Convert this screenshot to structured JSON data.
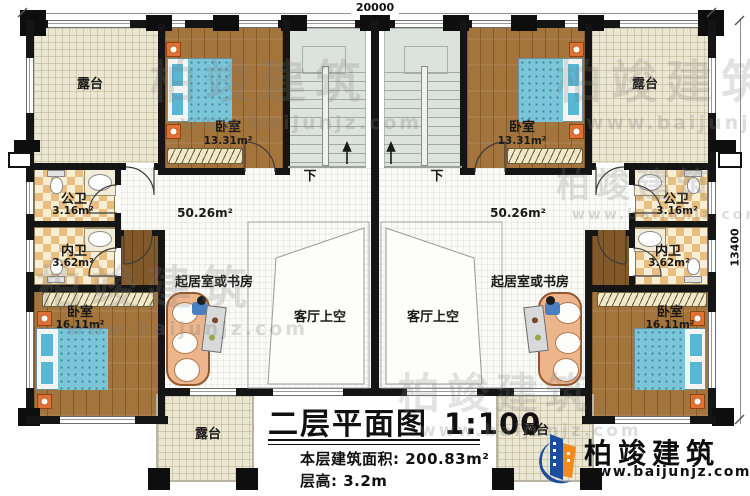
{
  "dimensions": {
    "top_width": "20000",
    "right_height": "13400"
  },
  "rooms": {
    "terrace": {
      "label": "露台"
    },
    "bedroom_front": {
      "label": "卧室",
      "area": "13.31m²"
    },
    "bedroom_rear": {
      "label": "卧室",
      "area": "16.11m²"
    },
    "public_bath": {
      "label": "公卫",
      "area": "3.16m²"
    },
    "private_bath": {
      "label": "内卫",
      "area": "3.62m²"
    },
    "living_study": {
      "label": "起居室或书房"
    },
    "living_void": {
      "label": "客厅上空"
    },
    "hall": {
      "area": "50.26m²"
    },
    "stairs": {
      "down": "下"
    }
  },
  "title_block": {
    "title": "二层平面图",
    "scale": "1:100",
    "area_label": "本层建筑面积:",
    "area_value": "200.83m²",
    "height_label": "层高:",
    "height_value": "3.2m"
  },
  "branding": {
    "company": "柏竣建筑",
    "website": "www.baijunjz.com"
  },
  "watermark": {
    "company": "柏竣建筑",
    "website": "www.baijunjz.com"
  },
  "colors": {
    "wall": "#151515",
    "wood": "#a3743c",
    "bed": "#7ac5d8",
    "logo_blue": "#1d4e9e",
    "logo_orange": "#f28a1d"
  }
}
